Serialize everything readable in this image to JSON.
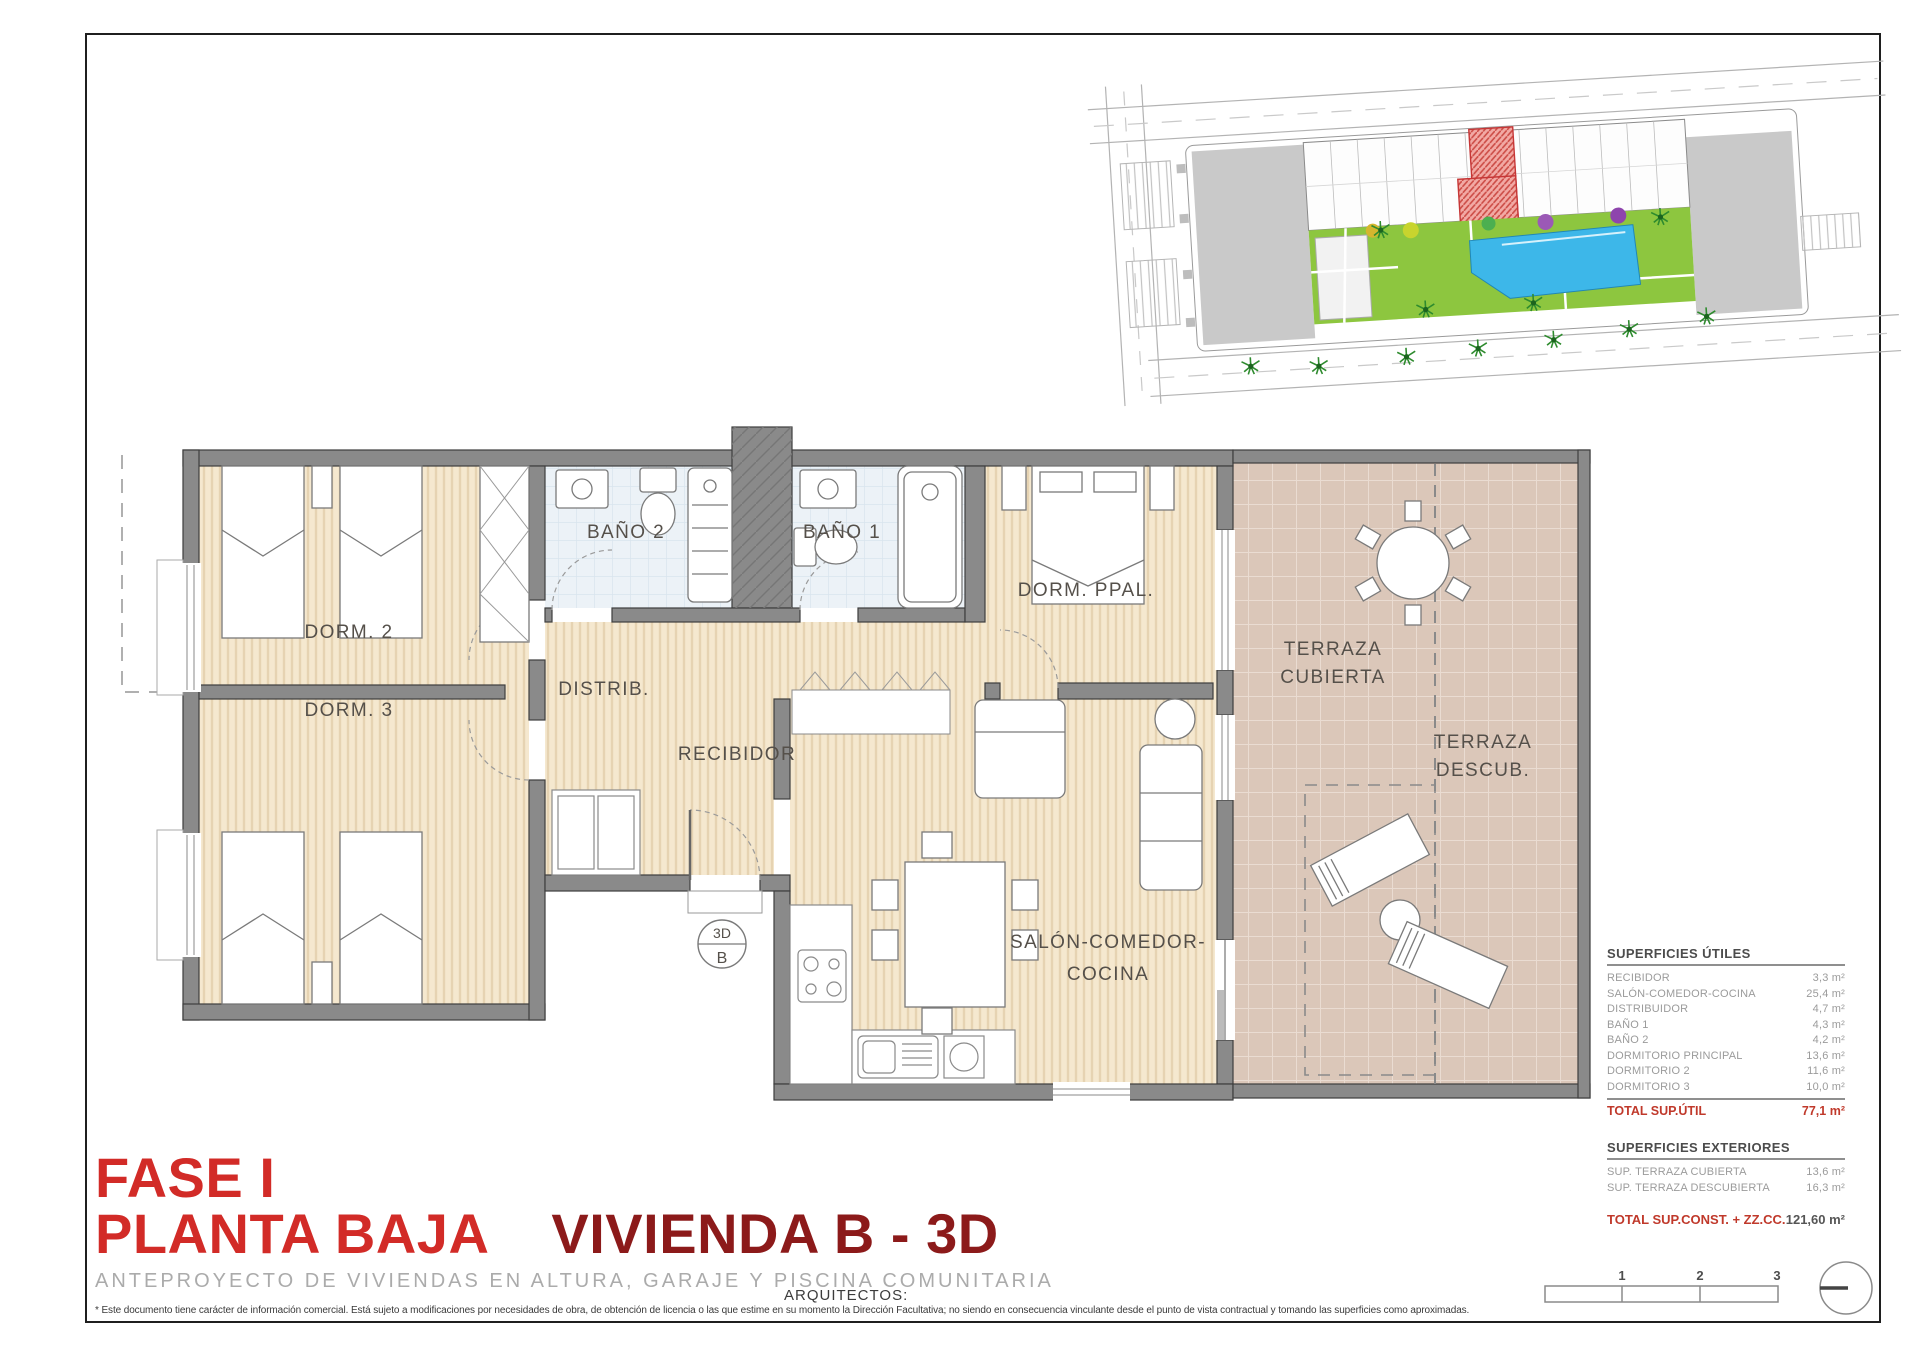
{
  "titles": {
    "phase": "FASE I",
    "floor": "PLANTA BAJA",
    "unit": "VIVIENDA B - 3D",
    "subtitle": "ANTEPROYECTO DE VIVIENDAS EN ALTURA, GARAJE Y PISCINA COMUNITARIA",
    "architects": "ARQUITECTOS:"
  },
  "disclaimer": "* Este documento tiene carácter de información comercial. Está sujeto a modificaciones por necesidades de obra, de obtención de licencia o las que estime en su momento la Dirección Facultativa; no siendo en consecuencia vinculante desde el punto de vista contractual y tomando las superficies como aproximadas.",
  "plan": {
    "marker": {
      "top": "3D",
      "bottom": "B"
    },
    "rooms": {
      "dorm2": "DORM. 2",
      "dorm3": "DORM. 3",
      "bano2": "BAÑO 2",
      "bano1": "BAÑO 1",
      "dorm_ppal": "DORM. PPAL.",
      "distrib": "DISTRIB.",
      "recibidor": "RECIBIDOR",
      "salon_line1": "SALÓN-COMEDOR-",
      "salon_line2": "COCINA",
      "terraza_cubierta_line1": "TERRAZA",
      "terraza_cubierta_line2": "CUBIERTA",
      "terraza_descubierta_line1": "TERRAZA",
      "terraza_descubierta_line2": "DESCUB."
    }
  },
  "tables": {
    "utiles": {
      "title": "SUPERFICIES ÚTILES",
      "rows": [
        {
          "label": "RECIBIDOR",
          "value": "3,3 m²"
        },
        {
          "label": "SALÓN-COMEDOR-COCINA",
          "value": "25,4 m²"
        },
        {
          "label": "DISTRIBUIDOR",
          "value": "4,7 m²"
        },
        {
          "label": "BAÑO 1",
          "value": "4,3 m²"
        },
        {
          "label": "BAÑO 2",
          "value": "4,2 m²"
        },
        {
          "label": "DORMITORIO PRINCIPAL",
          "value": "13,6 m²"
        },
        {
          "label": "DORMITORIO 2",
          "value": "11,6 m²"
        },
        {
          "label": "DORMITORIO 3",
          "value": "10,0 m²"
        }
      ],
      "total_label": "TOTAL SUP.ÚTIL",
      "total_value": "77,1 m²"
    },
    "exteriores": {
      "title": "SUPERFICIES EXTERIORES",
      "rows": [
        {
          "label": "SUP. TERRAZA CUBIERTA",
          "value": "13,6 m²"
        },
        {
          "label": "SUP. TERRAZA DESCUBIERTA",
          "value": "16,3 m²"
        }
      ],
      "total_label": "TOTAL SUP.CONST. + ZZ.CC.",
      "total_value": "121,60 m²"
    }
  },
  "scalebar": {
    "ticks": [
      "1",
      "2",
      "3"
    ]
  },
  "colors": {
    "accent_red": "#d22b27",
    "dark_red": "#8c1a1a",
    "total_red": "#c0392b",
    "wall_gray": "#8a8a8a",
    "wood_floor": "#f5e8cf",
    "terrace_floor": "#dbc7b9",
    "bath_floor": "#ecf2f7",
    "pool_blue": "#3db7e9",
    "garden_green": "#8dc63f",
    "highlight_unit_red": "#e05050"
  }
}
